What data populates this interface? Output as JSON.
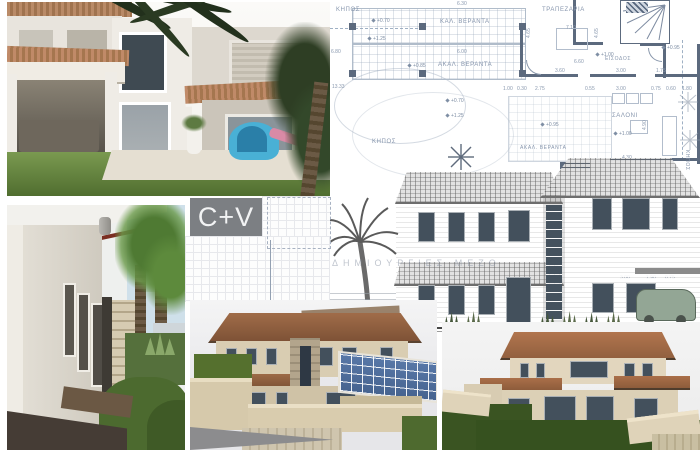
{
  "badge": {
    "logo": "C+V"
  },
  "colors": {
    "badge_bg": "#7c7f83",
    "plan_line": "#8a99af",
    "plan_wall": "#5c6a7e",
    "roof_render": "#9a6847",
    "roof_render_right": "#a96e48",
    "lawn_dark": "#3a5422"
  },
  "watermark": "ΔΗΜΙΟΥΡΓΙΕΣ ΜΕΖΟ",
  "plan": {
    "rooms": {
      "garden_top": "ΚΗΠΟΣ",
      "covered_veranda": "ΚΑΛ. ΒΕΡΑΝΤΑ",
      "dining": "ΤΡΑΠΕΖΑΡΙΑ",
      "uncovered_veranda": "ΑΚΑΛ. ΒΕΡΑΝΤΑ",
      "entrance": "ΕΙΣΟΔΟΣ",
      "living": "ΣΑΛΟΝΙ",
      "garden_left": "ΚΗΠΟΣ",
      "uncovered_veranda2": "ΑΚΑΛ. ΒΕΡΑΝΤΑ",
      "garden_right": "ΚΗΠΟΣ"
    },
    "annotations": [
      {
        "t": "6.30",
        "x": 457,
        "y": 2
      },
      {
        "t": "7.10",
        "x": 566,
        "y": 26
      },
      {
        "t": "6.80",
        "x": 331,
        "y": 50
      },
      {
        "t": "6.00",
        "x": 457,
        "y": 50
      },
      {
        "t": "13.33",
        "x": 332,
        "y": 85
      },
      {
        "t": "6.60",
        "x": 574,
        "y": 60
      },
      {
        "t": "3.60",
        "x": 555,
        "y": 69
      },
      {
        "t": "3.00",
        "x": 616,
        "y": 69
      },
      {
        "t": "1.75",
        "x": 656,
        "y": 69
      },
      {
        "t": "1.00",
        "x": 503,
        "y": 87
      },
      {
        "t": "0.30",
        "x": 517,
        "y": 87
      },
      {
        "t": "2.75",
        "x": 535,
        "y": 87
      },
      {
        "t": "0.55",
        "x": 585,
        "y": 87
      },
      {
        "t": "3.00",
        "x": 616,
        "y": 87
      },
      {
        "t": "0.75",
        "x": 651,
        "y": 87
      },
      {
        "t": "0.60",
        "x": 666,
        "y": 87
      },
      {
        "t": "1.80",
        "x": 682,
        "y": 87
      },
      {
        "t": "4.30",
        "x": 622,
        "y": 156
      },
      {
        "t": "4.65",
        "x": 527,
        "y": 38,
        "r": 1
      },
      {
        "t": "4.65",
        "x": 595,
        "y": 38,
        "r": 1
      },
      {
        "t": "4.90",
        "x": 643,
        "y": 130,
        "r": 1
      },
      {
        "t": "3.80",
        "x": 535,
        "y": 276
      },
      {
        "t": "3.00",
        "x": 620,
        "y": 276
      },
      {
        "t": "1.90",
        "x": 646,
        "y": 276
      },
      {
        "t": "0.75",
        "x": 665,
        "y": 276
      },
      {
        "t": "+0.70",
        "x": 372,
        "y": 19,
        "k": "lvl"
      },
      {
        "t": "+1.25",
        "x": 368,
        "y": 37,
        "k": "lvl"
      },
      {
        "t": "+0.85",
        "x": 408,
        "y": 64,
        "k": "lvl"
      },
      {
        "t": "+0.70",
        "x": 446,
        "y": 99,
        "k": "lvl"
      },
      {
        "t": "+1.25",
        "x": 446,
        "y": 114,
        "k": "lvl"
      },
      {
        "t": "+1.00",
        "x": 596,
        "y": 53,
        "k": "lvl"
      },
      {
        "t": "+0.95",
        "x": 662,
        "y": 46,
        "k": "lvl"
      },
      {
        "t": "+0.95",
        "x": 541,
        "y": 123,
        "k": "lvl"
      },
      {
        "t": "+1.00",
        "x": 614,
        "y": 132,
        "k": "lvl"
      },
      {
        "t": "+0.50",
        "x": 293,
        "y": 211,
        "k": "srv"
      },
      {
        "t": "100.12",
        "x": 286,
        "y": 220,
        "k": "srv"
      },
      {
        "t": "+0.12",
        "x": 293,
        "y": 227,
        "k": "srv"
      },
      {
        "t": "100.18",
        "x": 266,
        "y": 245,
        "k": "srv"
      },
      {
        "t": "+0.18",
        "x": 274,
        "y": 252,
        "k": "srv"
      },
      {
        "t": "+0.18",
        "x": 271,
        "y": 264,
        "k": "srv"
      },
      {
        "t": "100.17",
        "x": 265,
        "y": 290,
        "k": "srv"
      }
    ]
  }
}
